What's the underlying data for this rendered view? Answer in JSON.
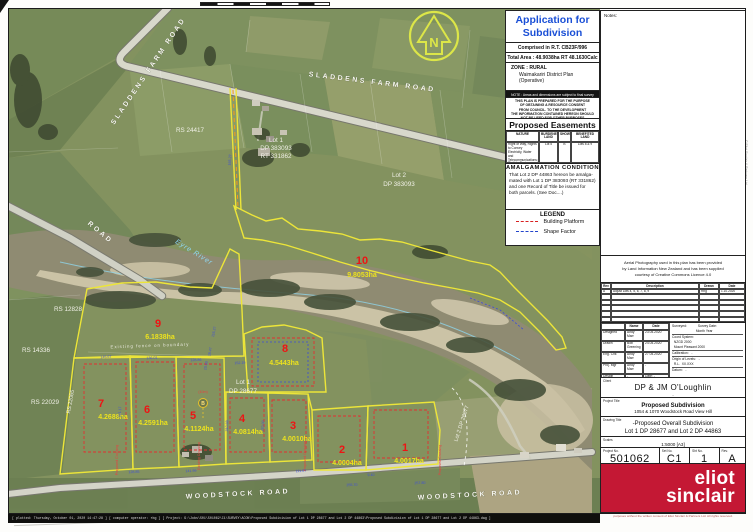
{
  "info_panel": {
    "title_line1": "Application for",
    "title_line2": "Subdivision Consent",
    "comprised": "Comprised in R.T. CB23F/996",
    "total_area": "Total  Area : 48.9038ha RT 48.1630Calc",
    "zone_lines": [
      "ZONE : RURAL",
      "Waimakariri District Plan",
      "(Operative)"
    ],
    "note_bar": "NOTE : Areas and dimensions are subject to final survey",
    "disclaimer_lines": [
      "THIS PLAN IS PREPARED FOR THE PURPOSE",
      "OF OBTAINING A RESOURCE CONSENT",
      "FROM COUNCIL. TO THE DEVELOPMENT",
      "THE INFORMATION CONTAINED HEREON SHOULD",
      "NOT BE USED FOR OTHER PURPOSES"
    ],
    "easements": {
      "title": "Proposed Easements",
      "headers": [
        "NATURE",
        "BURDENED LAND",
        "SHOWN",
        "BENEFITED LAND"
      ],
      "row": [
        "Right of Way, Rights to Convey Electricity, Water and Telecommunications; Right to Drain Sewage and Water",
        "Lot 5",
        "B",
        "Lots 8 & 9"
      ]
    },
    "amalgamation": {
      "title": "AMALGAMATION  CONDITION",
      "body_lines": [
        "That Lot 2 DP 44863 hereon be amalga-",
        "mated with Lot 1 DP 383093 (RT 331862)",
        "and one Record of Title be issued for",
        "both parcels. (See Doc....)"
      ]
    },
    "legend": {
      "title": "LEGEND",
      "items": [
        {
          "label": "Building Platform",
          "color": "#d82020"
        },
        {
          "label": "Shape Factor",
          "color": "#2244cc"
        }
      ]
    }
  },
  "title_block": {
    "notes_label": "Notes:",
    "aerial_note_lines": [
      "Aerial Photography used in this plan has been provided",
      "by Land Information New Zealand and has been supplied",
      "courtesy of Creative Commons Licence 4.0"
    ],
    "revision": {
      "rows": [
        [
          "Rev",
          "Description",
          "Drawn",
          "Date"
        ],
        [
          "A",
          "Adjust Lots 4, 5, 6, 7, 8, 9",
          "Rbg",
          "1.10.2020"
        ],
        [
          "",
          "",
          "",
          ""
        ],
        [
          "",
          "",
          "",
          ""
        ],
        [
          "",
          "",
          "",
          ""
        ],
        [
          "",
          "",
          "",
          ""
        ],
        [
          "",
          "",
          "",
          ""
        ]
      ]
    },
    "personnel": {
      "rows": [
        [
          "",
          "Name",
          "Date"
        ],
        [
          "Designed",
          "Andy Marr",
          "23.04.2020"
        ],
        [
          "Drawn",
          "Bob Greening",
          "24.04.2020"
        ],
        [
          "Eng. Chk",
          "Andy Marr",
          "27.04.2020"
        ],
        [
          "Proj. Mgr",
          "Andy Marr",
          "-"
        ],
        [
          "Design Review",
          "-",
          "Date:  -"
        ],
        [
          "Approved",
          "-",
          "Date:  -"
        ]
      ]
    },
    "survey_lines": [
      "Surveyed:            Survey Date:",
      "                          Month Year",
      "Coord System:",
      "  NZGD 2000",
      "  Mount Pleasant 2000",
      "Calibration:   -",
      "Origin of Levels:   -",
      "  R.L.  XX.XXX",
      "Datum:   -"
    ],
    "client": {
      "label": "Client",
      "name": "DP & JM O'Loughlin",
      "sub": "-"
    },
    "project_title": {
      "label": "Project Title",
      "line1": "Proposed Subdivision",
      "line2": "1054 & 1070 Woodstock Road View Hill"
    },
    "drawing_title": {
      "label": "Drawing Title",
      "line1": "-Proposed Overall Subdivision",
      "line2": "Lot 1 DP 28677 and Lot 2 DP 44863"
    },
    "scales": {
      "label": "Scales",
      "value": "1:5000  [A3]"
    },
    "numbers": [
      {
        "label": "Project No.",
        "value": "501062"
      },
      {
        "label": "Set No.",
        "value": "C1"
      },
      {
        "label": "Sht No.",
        "value": "1"
      },
      {
        "label": "Rev.",
        "value": "A"
      }
    ],
    "logo": {
      "line1": "eliot",
      "line2": "sinclair",
      "color": "#c41834"
    },
    "copyright": "purposes without the written consent of Eliot Sinclair & Partners Ltd. All rights reserved.",
    "side_text": "© Eliot Sinclair & Partners Ltd"
  },
  "footer": {
    "plot_info": "[ plotted: Thursday, October 01, 2020 14:47:28 ]  [ computer operator: rbg ]   [ Project: G:\\Jobs\\501\\501062\\C1\\SURVEY\\ACON\\Proposed Subdivision of Lot 1 DP 28677 and Lot 2 DP 44863\\Proposed Subdivision of Lot 1 DP 28677 and Lot 2 DP 44863.dwg ]"
  },
  "map": {
    "north_label": "N",
    "easement_b": {
      "label": "B"
    },
    "labels": [
      {
        "t": "SLADDENS  FARM  ROAD",
        "x": 150,
        "y": 72,
        "r": -56,
        "c": "road",
        "n": "road-label-sladdens-1"
      },
      {
        "t": "SLADDENS   FARM   ROAD",
        "x": 372,
        "y": 84,
        "r": 7,
        "c": "road",
        "n": "road-label-sladdens-2"
      },
      {
        "t": "WOODSTOCK   ROAD",
        "x": 238,
        "y": 496,
        "r": -3,
        "c": "road",
        "n": "road-label-woodstock-1"
      },
      {
        "t": "WOODSTOCK    ROAD",
        "x": 470,
        "y": 497,
        "r": -3,
        "c": "road",
        "n": "road-label-woodstock-2"
      },
      {
        "t": "ROAD",
        "x": 99,
        "y": 234,
        "r": 40,
        "c": "road",
        "n": "road-label-west"
      },
      {
        "t": "RS 24417",
        "x": 190,
        "y": 132,
        "r": 0,
        "c": "wlabel",
        "n": "parcel-label"
      },
      {
        "t": "Lot 1",
        "x": 276,
        "y": 142,
        "r": 0,
        "c": "wlabel",
        "n": "parcel-label"
      },
      {
        "t": "DP 383093",
        "x": 276,
        "y": 150,
        "r": 0,
        "c": "wlabel",
        "n": "parcel-label"
      },
      {
        "t": "RT 331862",
        "x": 276,
        "y": 158,
        "r": 0,
        "c": "wlabel",
        "n": "parcel-label"
      },
      {
        "t": "Lot 2",
        "x": 399,
        "y": 177,
        "r": 0,
        "c": "wlabel",
        "n": "parcel-label"
      },
      {
        "t": "DP 383093",
        "x": 399,
        "y": 186,
        "r": 0,
        "c": "wlabel",
        "n": "parcel-label"
      },
      {
        "t": "RS 12828",
        "x": 68,
        "y": 311,
        "r": 0,
        "c": "wlabel",
        "n": "parcel-label"
      },
      {
        "t": "RS 14336",
        "x": 36,
        "y": 352,
        "r": 0,
        "c": "wlabel",
        "n": "parcel-label"
      },
      {
        "t": "RS 22029",
        "x": 45,
        "y": 404,
        "r": 0,
        "c": "wlabel",
        "n": "parcel-label"
      },
      {
        "t": "RS 22065",
        "x": 72,
        "y": 402,
        "r": -80,
        "c": "wsm",
        "n": "parcel-label"
      },
      {
        "t": "Lot 1",
        "x": 243,
        "y": 384,
        "r": 0,
        "c": "wlabel",
        "n": "parcel-label"
      },
      {
        "t": "DP 28677",
        "x": 243,
        "y": 393,
        "r": 0,
        "c": "wlabel",
        "n": "parcel-label"
      },
      {
        "t": "Lot 2 DP 28677",
        "x": 463,
        "y": 424,
        "r": -72,
        "c": "wsm",
        "n": "parcel-label"
      },
      {
        "t": "Eyre  River",
        "x": 193,
        "y": 254,
        "r": 32,
        "c": "river",
        "n": "river-label"
      },
      {
        "t": "Existing  fence  on  boundary",
        "x": 150,
        "y": 347,
        "r": -2,
        "c": "fence",
        "n": "fence-note"
      },
      {
        "t": "10",
        "x": 362,
        "y": 264,
        "r": 0,
        "c": "rednum",
        "n": "lot-10-number"
      },
      {
        "t": "9.8053ha",
        "x": 362,
        "y": 277,
        "r": 0,
        "c": "area",
        "n": "lot-10-area"
      },
      {
        "t": "9",
        "x": 158,
        "y": 327,
        "r": 0,
        "c": "rednum",
        "n": "lot-9-number"
      },
      {
        "t": "6.1838ha",
        "x": 160,
        "y": 339,
        "r": 0,
        "c": "area",
        "n": "lot-9-area"
      },
      {
        "t": "8",
        "x": 285,
        "y": 352,
        "r": 0,
        "c": "rednum",
        "n": "lot-8-number"
      },
      {
        "t": "4.5443ha",
        "x": 284,
        "y": 365,
        "r": 0,
        "c": "area",
        "n": "lot-8-area"
      },
      {
        "t": "7",
        "x": 101,
        "y": 407,
        "r": 0,
        "c": "rednum",
        "n": "lot-7-number"
      },
      {
        "t": "4.2688ha",
        "x": 113,
        "y": 419,
        "r": 0,
        "c": "area",
        "n": "lot-7-area"
      },
      {
        "t": "6",
        "x": 147,
        "y": 413,
        "r": 0,
        "c": "rednum",
        "n": "lot-6-number"
      },
      {
        "t": "4.2591ha",
        "x": 153,
        "y": 425,
        "r": 0,
        "c": "area",
        "n": "lot-6-area"
      },
      {
        "t": "5",
        "x": 193,
        "y": 419,
        "r": 0,
        "c": "rednum",
        "n": "lot-5-number"
      },
      {
        "t": "4.1124ha",
        "x": 199,
        "y": 431,
        "r": 0,
        "c": "area",
        "n": "lot-5-area"
      },
      {
        "t": "4",
        "x": 242,
        "y": 422,
        "r": 0,
        "c": "rednum",
        "n": "lot-4-number"
      },
      {
        "t": "4.0814ha",
        "x": 248,
        "y": 434,
        "r": 0,
        "c": "area",
        "n": "lot-4-area"
      },
      {
        "t": "3",
        "x": 293,
        "y": 429,
        "r": 0,
        "c": "rednum",
        "n": "lot-3-number"
      },
      {
        "t": "4.0010ha",
        "x": 297,
        "y": 441,
        "r": 0,
        "c": "area",
        "n": "lot-3-area"
      },
      {
        "t": "2",
        "x": 342,
        "y": 453,
        "r": 0,
        "c": "rednum",
        "n": "lot-2-number"
      },
      {
        "t": "4.0004ha",
        "x": 347,
        "y": 465,
        "r": 0,
        "c": "area",
        "n": "lot-2-area"
      },
      {
        "t": "1",
        "x": 405,
        "y": 451,
        "r": 0,
        "c": "rednum",
        "n": "lot-1-number"
      },
      {
        "t": "4.0017ha",
        "x": 409,
        "y": 463,
        "r": 0,
        "c": "area",
        "n": "lot-1-area"
      },
      {
        "t": "(10m)",
        "x": 203,
        "y": 393,
        "r": 0,
        "c": "rednote",
        "n": "easement-width-note"
      },
      {
        "t": "Proposed Crossing",
        "x": 118,
        "y": 460,
        "r": -90,
        "c": "rednote",
        "n": "crossing-note"
      },
      {
        "t": "Existing Crossing",
        "x": 200,
        "y": 456,
        "r": -90,
        "c": "rednote",
        "n": "crossing-note"
      },
      {
        "t": "Proposed Crossing",
        "x": 306,
        "y": 456,
        "r": -90,
        "c": "rednote",
        "n": "crossing-note"
      },
      {
        "t": "Proposed Crossing",
        "x": 441,
        "y": 460,
        "r": -90,
        "c": "rednote",
        "n": "crossing-note"
      },
      {
        "t": "145.67",
        "x": 106,
        "y": 358,
        "r": -3,
        "c": "dim",
        "n": "dimension"
      },
      {
        "t": "136.01",
        "x": 152,
        "y": 359,
        "r": -3,
        "c": "dim",
        "n": "dimension"
      },
      {
        "t": "128.86",
        "x": 196,
        "y": 361,
        "r": -3,
        "c": "dim",
        "n": "dimension"
      },
      {
        "t": "152.19",
        "x": 240,
        "y": 364,
        "r": -3,
        "c": "dim",
        "n": "dimension"
      },
      {
        "t": "116.27",
        "x": 215,
        "y": 332,
        "r": -78,
        "c": "dim",
        "n": "dimension"
      },
      {
        "t": "18.47",
        "x": 211,
        "y": 352,
        "r": -78,
        "c": "dim",
        "n": "dimension"
      },
      {
        "t": "10.00",
        "x": 207,
        "y": 366,
        "r": -78,
        "c": "dim",
        "n": "dimension"
      },
      {
        "t": "165.27",
        "x": 231,
        "y": 160,
        "r": -86,
        "c": "dim",
        "n": "dimension"
      },
      {
        "t": "311.17",
        "x": 121,
        "y": 412,
        "r": -87,
        "c": "dim",
        "n": "dimension"
      },
      {
        "t": "310.68",
        "x": 228,
        "y": 426,
        "r": -87,
        "c": "dim",
        "n": "dimension"
      },
      {
        "t": "270.00",
        "x": 264,
        "y": 426,
        "r": -87,
        "c": "dim",
        "n": "dimension"
      },
      {
        "t": "128.85",
        "x": 134,
        "y": 473,
        "r": -3,
        "c": "dim",
        "n": "dimension"
      },
      {
        "t": "141.99",
        "x": 191,
        "y": 472,
        "r": -3,
        "c": "dim",
        "n": "dimension"
      },
      {
        "t": "111.07",
        "x": 301,
        "y": 472,
        "r": -3,
        "c": "dim",
        "n": "dimension"
      },
      {
        "t": "255.70",
        "x": 352,
        "y": 486,
        "r": -2,
        "c": "dim",
        "n": "dimension"
      },
      {
        "t": "257.80",
        "x": 420,
        "y": 484,
        "r": -2,
        "c": "dim",
        "n": "dimension"
      },
      {
        "t": "9.40",
        "x": 371,
        "y": 476,
        "r": -2,
        "c": "dim",
        "n": "dimension"
      }
    ]
  }
}
